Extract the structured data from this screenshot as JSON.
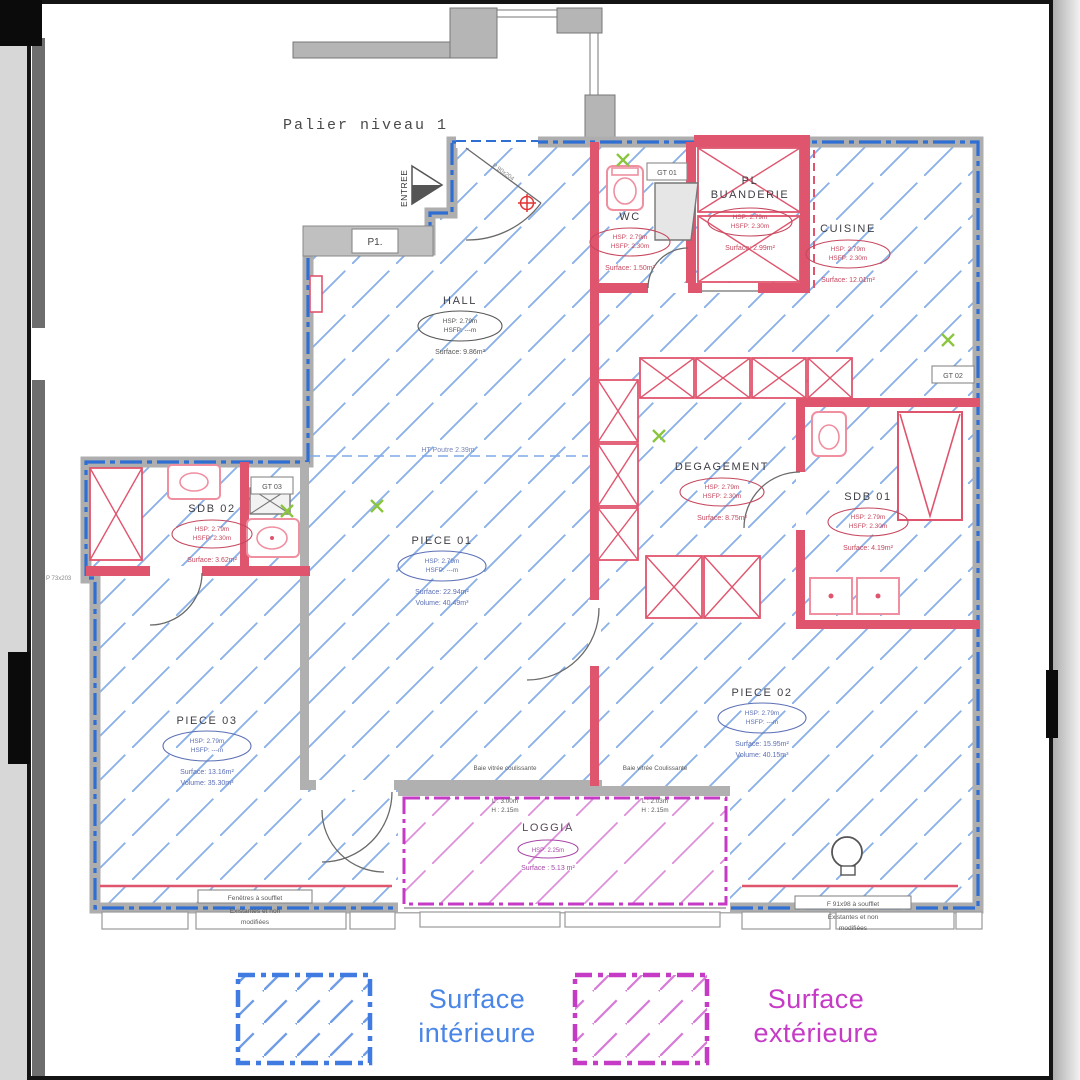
{
  "page": {
    "palier_label": "Palier niveau 1",
    "entree_label": "ENTREE",
    "p1_label": "P1.",
    "gt01_label": "GT 01",
    "gt02_label": "GT 02",
    "gt03_label": "GT 03",
    "beam_note": "HT Poutre 2.39m",
    "door_entrance_label": "P 90x204",
    "door_sdb02_label": "P 73x203"
  },
  "rooms": {
    "hall": {
      "name": "HALL",
      "hsp": "HSP: 2.79m",
      "hsfp": "HSFP: ---m",
      "surface": "Surface: 9.86m²"
    },
    "wc": {
      "name": "WC",
      "hsp": "HSP: 2.79m",
      "hsfp": "HSFP: 2.30m",
      "surface": "Surface: 1.50m²"
    },
    "buanderie": {
      "pl": "PL",
      "name": "BUANDERIE",
      "hsp": "HSP: 2.79m",
      "hsfp": "HSFP: 2.30m",
      "surface": "Surface: 2.99m²"
    },
    "cuisine": {
      "name": "CUISINE",
      "hsp": "HSP: 2.79m",
      "hsfp": "HSFP: 2.30m",
      "surface": "Surface: 12.01m²"
    },
    "degagement": {
      "name": "DEGAGEMENT",
      "hsp": "HSP: 2.79m",
      "hsfp": "HSFP: 2.30m",
      "surface": "Surface: 8.75m²"
    },
    "sdb01": {
      "name": "SDB 01",
      "hsp": "HSP: 2.79m",
      "hsfp": "HSFP: 2.30m",
      "surface": "Surface: 4.19m²"
    },
    "sdb02": {
      "name": "SDB 02",
      "hsp": "HSP: 2.79m",
      "hsfp": "HSFP: 2.30m",
      "surface": "Surface: 3.62m²"
    },
    "piece01": {
      "name": "PIECE 01",
      "hsp": "HSP: 2.79m",
      "hsfp": "HSFP: ---m",
      "surface": "Surface: 22.94m²",
      "volume": "Volume: 40.49m³"
    },
    "piece02": {
      "name": "PIECE 02",
      "hsp": "HSP: 2.79m",
      "hsfp": "HSFP: ---m",
      "surface": "Surface: 15.95m²",
      "volume": "Volume: 40.15m³"
    },
    "piece03": {
      "name": "PIECE 03",
      "hsp": "HSP: 2.79m",
      "hsfp": "HSFP: ---m",
      "surface": "Surface: 13.16m²",
      "volume": "Volume: 35.30m³"
    },
    "loggia": {
      "name": "LOGGIA",
      "hsp": "HSP: 2.25m",
      "surface": "Surface : 5.13 m²"
    }
  },
  "bays": {
    "left": {
      "label": "Baie vitrée coulissante",
      "dim1": "L : 3.00m",
      "dim2": "H : 2.15m"
    },
    "right": {
      "label": "Baie vitrée Coulissante",
      "dim1": "L : 2.03m",
      "dim2": "H : 2.15m"
    }
  },
  "window_notes": {
    "left": {
      "l1": "Fenêtres à soufflet",
      "l2": "Existantes et non",
      "l3": "modifiées"
    },
    "right": {
      "l1": "F 91x98 à soufflet",
      "l2": "Existantes et non",
      "l3": "modifiées"
    }
  },
  "legend": {
    "interior_l1": "Surface",
    "interior_l2": "intérieure",
    "exterior_l1": "Surface",
    "exterior_l2": "extérieure"
  },
  "colors": {
    "interior_boundary": "#2f6fd3",
    "interior_hatch": "#8ab1e8",
    "exterior_boundary": "#c63bc6",
    "exterior_hatch": "#dd8fd9",
    "new_wall_red": "#e0556e",
    "legend_interior_text": "#4a86e8",
    "legend_exterior_text": "#c63bc6"
  }
}
